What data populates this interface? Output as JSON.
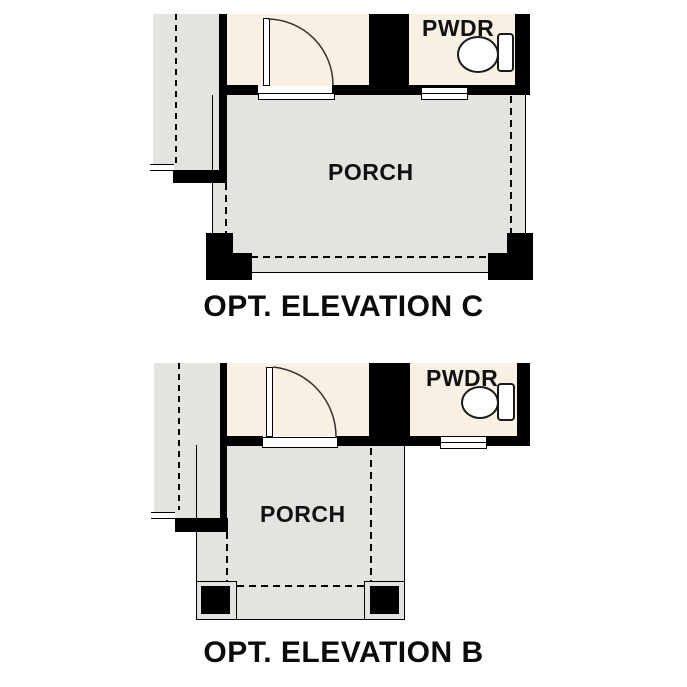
{
  "figure": {
    "type": "architectural-floor-plan-options",
    "background": "#ffffff",
    "colors": {
      "wall": "#000000",
      "interior_fill": "#f7f0e3",
      "slab_fill": "#e4e3e0",
      "line": "#000000",
      "fixture_fill": "#ffffff"
    },
    "icons": {
      "toilet": "toilet-icon",
      "door_swing": "door-swing-icon",
      "window": "window-symbol"
    },
    "plans": [
      {
        "caption": "OPT. ELEVATION C",
        "rooms": {
          "powder": "PWDR",
          "porch": "PORCH"
        }
      },
      {
        "caption": "OPT. ELEVATION B",
        "rooms": {
          "powder": "PWDR",
          "porch": "PORCH"
        }
      }
    ]
  }
}
